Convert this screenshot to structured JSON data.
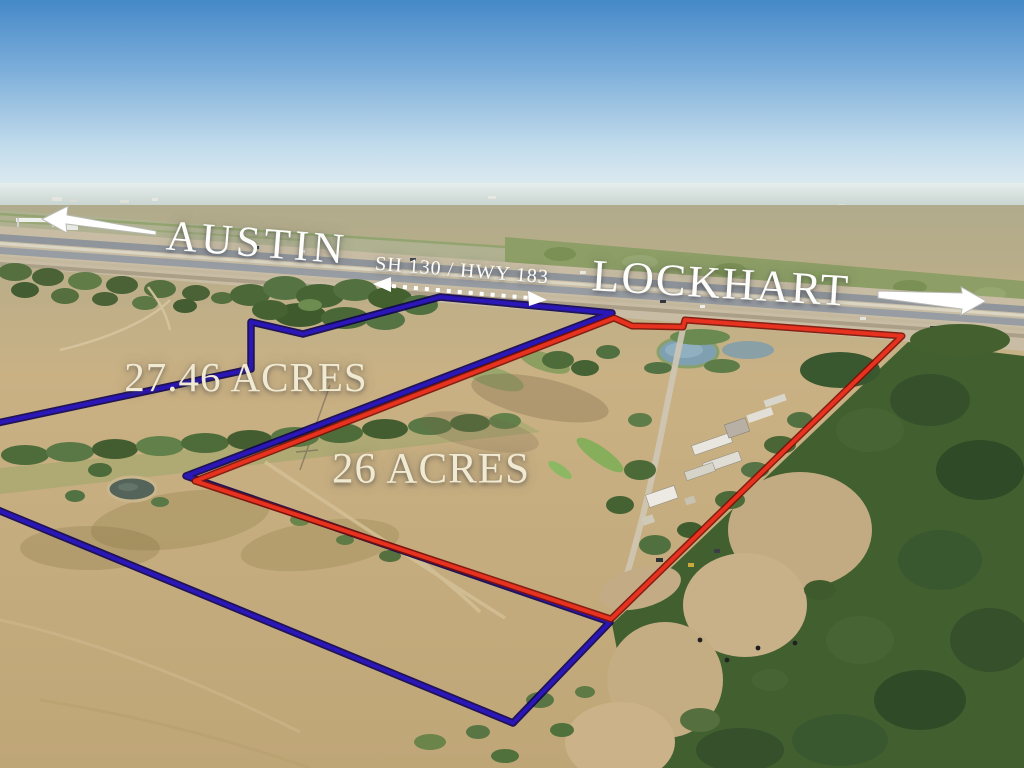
{
  "overlay": {
    "direction_left": {
      "label": "AUSTIN"
    },
    "direction_right": {
      "label": "LOCKHART"
    },
    "highway": {
      "label": "SH 130 / HWY 183"
    },
    "parcels": [
      {
        "label": "27.46 ACRES",
        "boundary_color": "#2b16b8"
      },
      {
        "label": "26 ACRES",
        "boundary_color": "#e6321f"
      }
    ]
  },
  "colors": {
    "boundary-blue": "#2b16b8",
    "boundary-blue-dark": "#0e0350",
    "boundary-red": "#e6321f",
    "boundary-red-dark": "#7c0f06",
    "label-white": "#fdfdfb",
    "label-cream": "#f1ead2"
  }
}
